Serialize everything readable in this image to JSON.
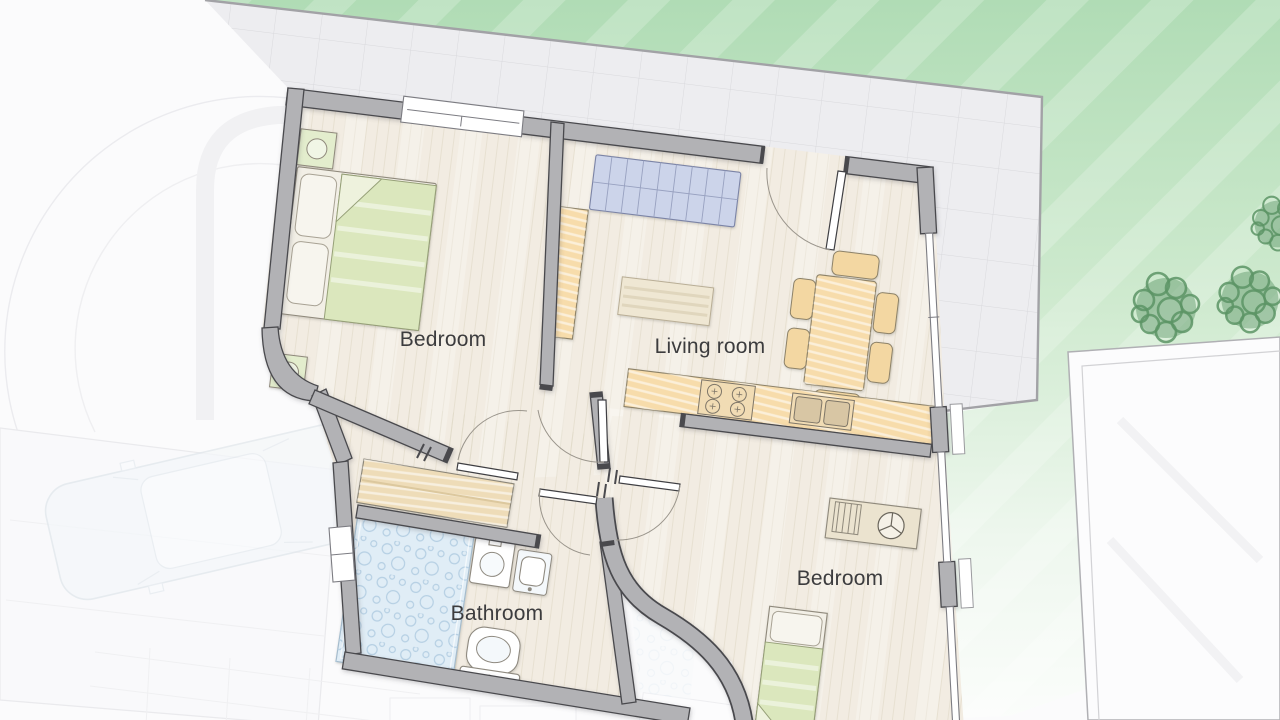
{
  "floorplan": {
    "rooms": [
      {
        "id": "bedroom-1",
        "label": "Bedroom"
      },
      {
        "id": "living-room",
        "label": "Living room"
      },
      {
        "id": "bathroom",
        "label": "Bathroom"
      },
      {
        "id": "bedroom-2",
        "label": "Bedroom"
      }
    ],
    "furniture": [
      "double-bed",
      "nightstand-top",
      "nightstand-bottom",
      "sofa",
      "sideboard",
      "rug",
      "dining-table",
      "dining-chairs",
      "kitchen-counter",
      "stove",
      "kitchen-sink",
      "desk",
      "desk-chair",
      "single-bed",
      "wardrobe",
      "shower",
      "washbasin-left",
      "washbasin-right",
      "toilet"
    ],
    "outdoor": [
      "tiled-terrace",
      "lawn",
      "trees",
      "neighbor-terrace",
      "stairwell",
      "garage",
      "car"
    ]
  },
  "colors": {
    "background": "#fbfbfc",
    "wall-fill": "#b2b2b5",
    "wall-edge": "#4a4a4e",
    "floor": "#f2ece2",
    "floor-line": "#e0d8c6",
    "terrace": "#ededf0",
    "terrace-grid": "#d9d9dd",
    "lawn": "#b2ddb6",
    "tree": "#5c9465",
    "bed-green": "#dbe7bd",
    "counter-orange": "#f7dcab",
    "sofa-blue": "#ccd4ea",
    "shower-blue": "#e0edf6",
    "wood-beige": "#eedcb8",
    "label-text": "#3c3c3e",
    "door-arc": "#9a958c",
    "glass": "#ffffff"
  }
}
